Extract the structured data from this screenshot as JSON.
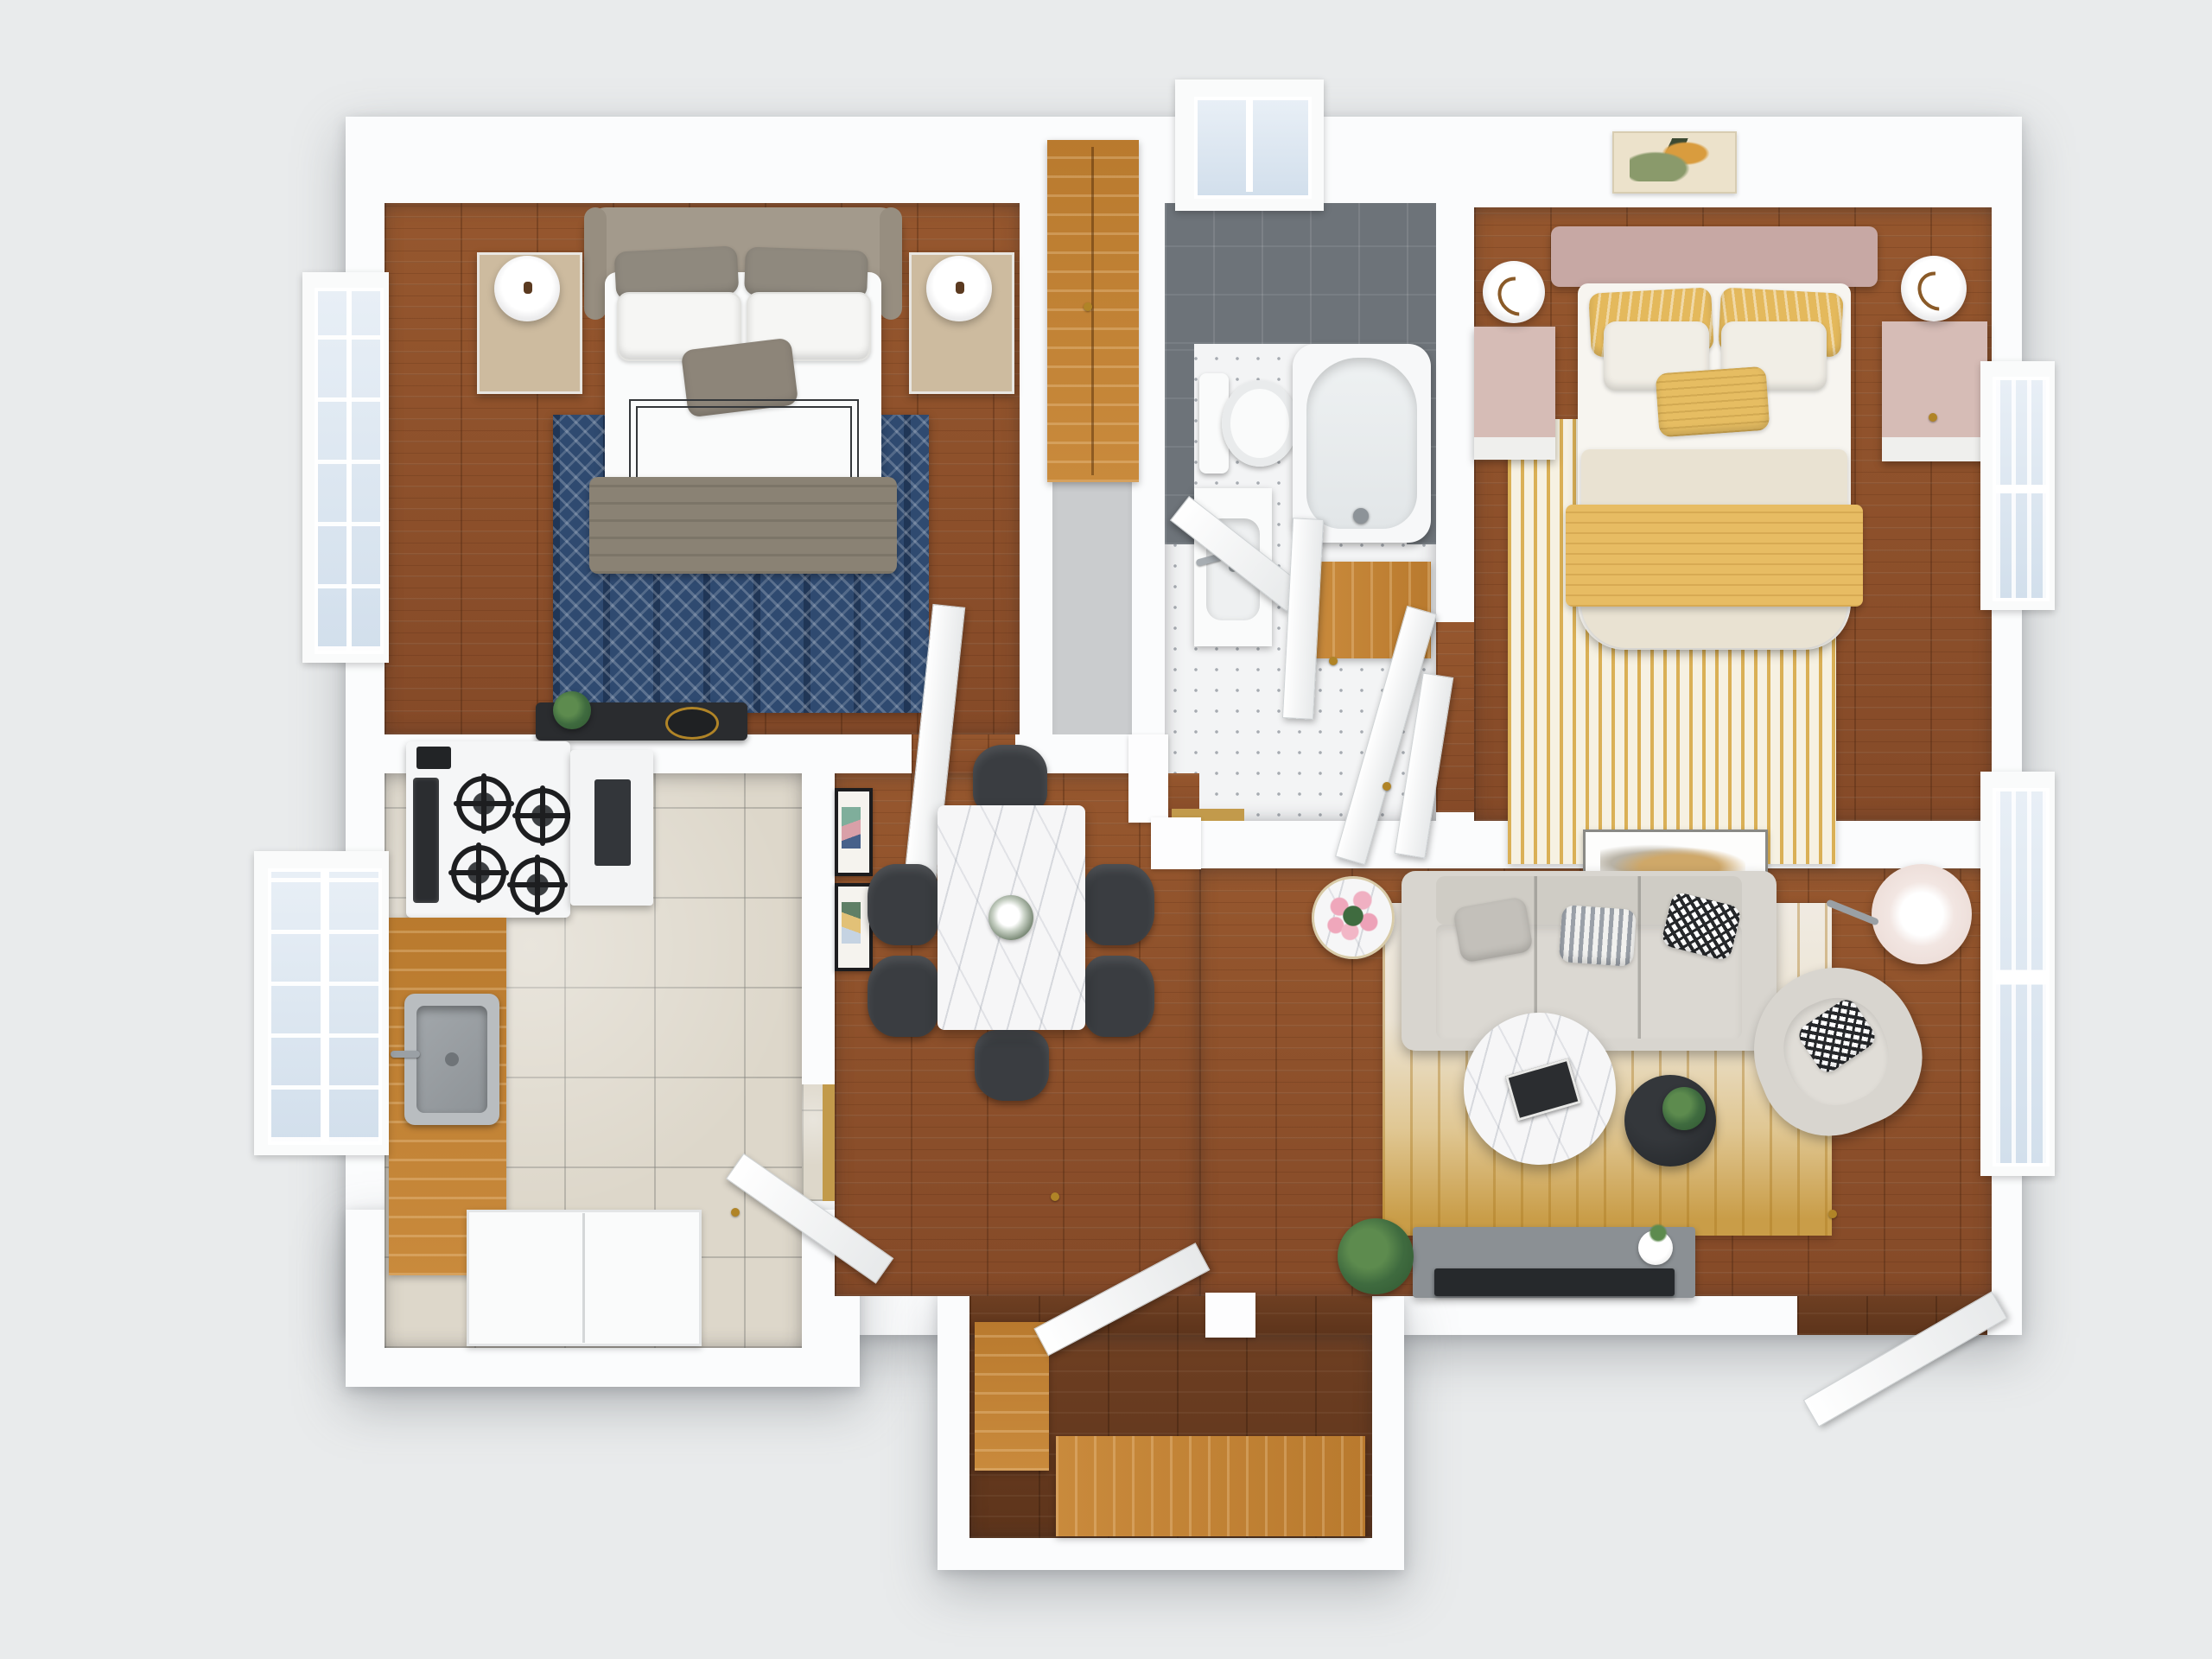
{
  "scene": {
    "type": "3d-floor-plan-render",
    "view": "top-down dollhouse",
    "background_color": "#e9ebec",
    "text_visible": "none"
  },
  "palette": {
    "wall": "#fbfcfd",
    "wood_floor": "#8e5231",
    "wood_floor_dark": "#6b3d20",
    "kitchen_tile": "#ddd7ca",
    "bath_mosaic_floor": "#f3f4f5",
    "bath_wall_tile": "#6d7379",
    "cabinet_wood": "#c28135",
    "navy_rug": "#2f4a70",
    "gold_accent": "#d5a43d",
    "living_rug_gold": "#c99d48",
    "sofa_fabric": "#d8d5cf",
    "dining_chair": "#3a3d41",
    "marble": "#f6f6f7",
    "headboard_taupe": "#a39a8c",
    "headboard_pink": "#c7a8a4",
    "bedding_white": "#fafafa",
    "bedding_cream": "#e9e2d2",
    "pillow_yellow": "#e4b95c",
    "tv_console_gray": "#8b9094",
    "tv_screen": "#26292c",
    "plant_green": "#3f6b3f",
    "flower_pink": "#efa7bb",
    "brass_hardware": "#b08427"
  },
  "rooms": [
    {
      "id": "bedroom-1",
      "position": "top-left",
      "floor": "hardwood",
      "items": [
        "upholstered-bed",
        "gray-pillows",
        "white-pillows",
        "accent-pillow",
        "taupe-throw-blanket",
        "navy-patterned-rug",
        "nightstand-left",
        "nightstand-right",
        "table-lamp-left",
        "table-lamp-right",
        "dark-dresser",
        "plant",
        "window-left"
      ]
    },
    {
      "id": "closet-hall",
      "position": "top-center-left",
      "floor": "gray-carpet",
      "items": [
        "tall-wood-wardrobe",
        "bedroom-door"
      ]
    },
    {
      "id": "bathroom",
      "position": "top-center",
      "floor": "white-mosaic-tile",
      "items": [
        "gray-tiled-walls",
        "window-top",
        "toilet",
        "vanity-sink",
        "bathtub",
        "linen-shelf-wood",
        "doors-ajar",
        "gold-threshold"
      ]
    },
    {
      "id": "bedroom-2",
      "position": "top-right",
      "floor": "hardwood",
      "items": [
        "pink-headboard-bed",
        "yellow-pillows",
        "white-pillows",
        "cream-duvet",
        "yellow-throw",
        "gold-dash-rug",
        "nightstand-left",
        "nightstand-right",
        "table-lamps",
        "leaf-wall-art",
        "window-right"
      ]
    },
    {
      "id": "kitchen",
      "position": "bottom-left",
      "floor": "ceramic-tile",
      "items": [
        "range-stove-4-burners",
        "oven-window",
        "microwave",
        "butcher-block-counter",
        "stainless-sink",
        "lower-cabinet-run",
        "window-left",
        "door-ajar",
        "gold-threshold"
      ]
    },
    {
      "id": "dining-room",
      "position": "center",
      "floor": "hardwood",
      "items": [
        "marble-dining-table",
        "dining-chairs",
        "centerpiece",
        "gallery-frames-on-wall"
      ]
    },
    {
      "id": "living-room",
      "position": "right",
      "floor": "hardwood",
      "items": [
        "three-seat-sofa",
        "gray-pillow",
        "striped-pillow",
        "houndstooth-pillow",
        "flower-side-table",
        "pink-tulips",
        "floor-lamp",
        "gold-abstract-rug",
        "marble-coffee-table",
        "books",
        "black-side-table",
        "potted-plant",
        "accent-armchair",
        "tv-console",
        "television",
        "white-vase",
        "wall-art",
        "windows-right",
        "door-ajar"
      ]
    },
    {
      "id": "entry-vestibule",
      "position": "bottom-center",
      "floor": "dark-hardwood",
      "items": [
        "wood-bench",
        "wood-console",
        "front-door-ajar"
      ]
    }
  ],
  "counts": {
    "bedrooms": 2,
    "bathrooms": 1,
    "dining_chairs": 6,
    "stove_burners": 4,
    "sofa_back_cushions": 3,
    "sofa_throw_pillows": 3,
    "gallery_frames": 2
  }
}
